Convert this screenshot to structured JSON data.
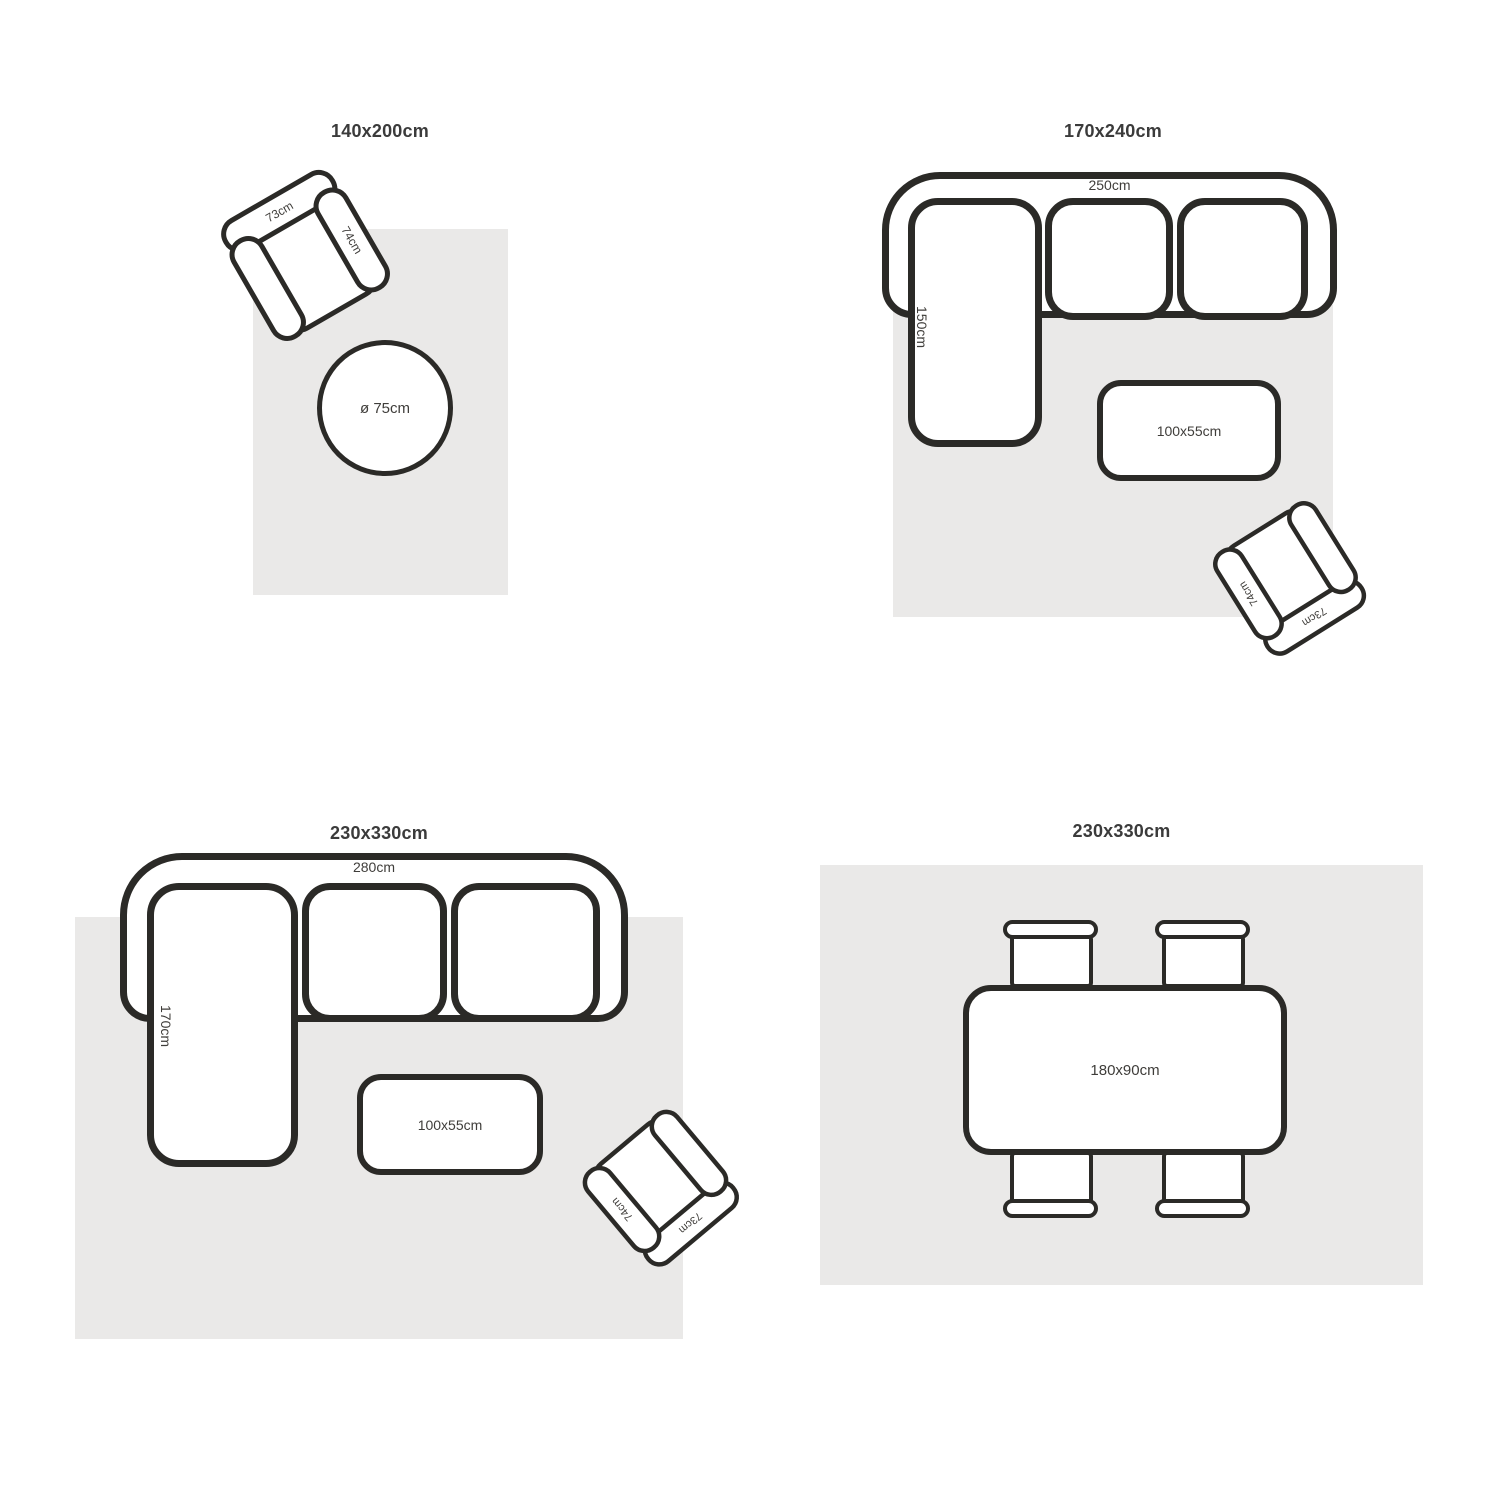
{
  "colors": {
    "rug": "#eae9e8",
    "line": "#2b2a27",
    "label_text": "#3f3d3a",
    "title_text": "#3b3b3b"
  },
  "panels": [
    {
      "title": "140x200cm",
      "chair": {
        "back_width": "73cm",
        "arm_depth": "74cm"
      },
      "round_table_diameter": "ø 75cm"
    },
    {
      "title": "170x240cm",
      "sofa": {
        "total_width": "250cm",
        "chaise_depth": "150cm"
      },
      "coffee_table_size": "100x55cm",
      "chair": {
        "back_width": "73cm",
        "arm_depth": "74cm"
      }
    },
    {
      "title": "230x330cm",
      "sofa": {
        "total_width": "280cm",
        "chaise_depth": "170cm"
      },
      "coffee_table_size": "100x55cm",
      "chair": {
        "back_width": "73cm",
        "arm_depth": "74cm"
      }
    },
    {
      "title": "230x330cm",
      "dining_table_size": "180x90cm"
    }
  ]
}
